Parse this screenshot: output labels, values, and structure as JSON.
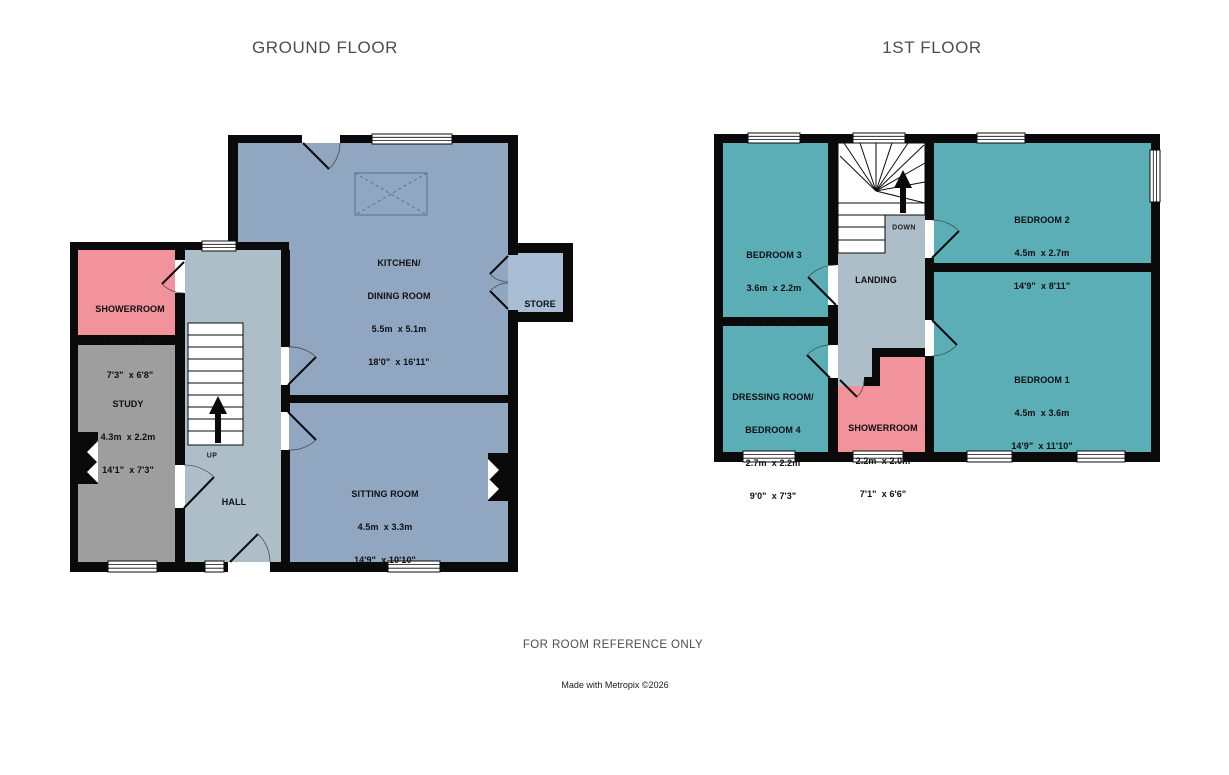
{
  "page": {
    "footer_note": "FOR ROOM REFERENCE ONLY",
    "credit": "Made with Metropix ©2026"
  },
  "colors": {
    "wall": "#0a0a0a",
    "blue": "#91A6C0",
    "store_blue": "#A9BDD4",
    "hall_gray": "#ADBEC8",
    "pink": "#F2929B",
    "study_gray": "#9E9E9E",
    "teal": "#5BAEB5"
  },
  "floors": [
    {
      "title": "GROUND FLOOR",
      "stair_label": "UP",
      "rooms": [
        {
          "id": "kitchen-dining-room",
          "name": "KITCHEN/",
          "name2": "DINING ROOM",
          "metric": "5.5m  x 5.1m",
          "imperial": "18'0\"  x 16'11\""
        },
        {
          "id": "store",
          "name": "STORE"
        },
        {
          "id": "showerroom",
          "name": "SHOWERROOM",
          "metric": "2.2m  x 2.0m",
          "imperial": "7'3\"  x 6'8\""
        },
        {
          "id": "study",
          "name": "STUDY",
          "metric": "4.3m  x 2.2m",
          "imperial": "14'1\"  x 7'3\""
        },
        {
          "id": "hall",
          "name": "HALL"
        },
        {
          "id": "sitting-room",
          "name": "SITTING ROOM",
          "metric": "4.5m  x 3.3m",
          "imperial": "14'9\"  x 10'10\""
        }
      ]
    },
    {
      "title": "1ST FLOOR",
      "stair_label": "DOWN",
      "rooms": [
        {
          "id": "bedroom-3",
          "name": "BEDROOM 3",
          "metric": "3.6m  x 2.2m",
          "imperial": "11'9\"  x 7'3\""
        },
        {
          "id": "bedroom-2",
          "name": "BEDROOM 2",
          "metric": "4.5m  x 2.7m",
          "imperial": "14'9\"  x 8'11\""
        },
        {
          "id": "bedroom-1",
          "name": "BEDROOM 1",
          "metric": "4.5m  x 3.6m",
          "imperial": "14'9\"  x 11'10\""
        },
        {
          "id": "dressing-room-bedroom-4",
          "name": "DRESSING ROOM/",
          "name2": "BEDROOM 4",
          "metric": "2.7m  x 2.2m",
          "imperial": "9'0\"  x 7'3\""
        },
        {
          "id": "showerroom",
          "name": "SHOWERROOM",
          "metric": "2.2m  x 2.0m",
          "imperial": "7'1\"  x 6'6\""
        },
        {
          "id": "landing",
          "name": "LANDING"
        }
      ]
    }
  ]
}
